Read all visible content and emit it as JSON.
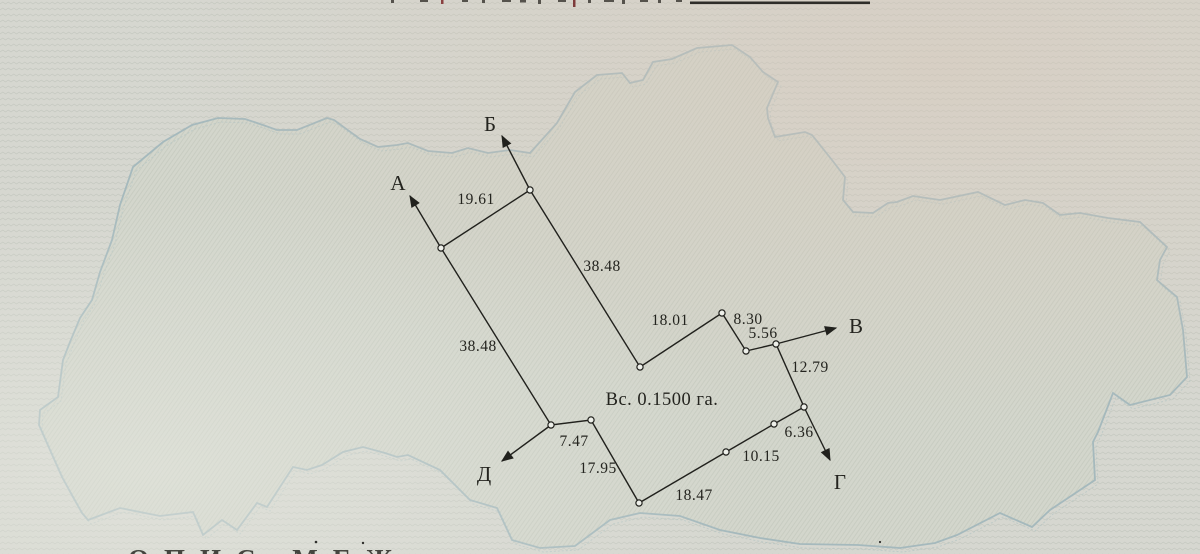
{
  "map": {
    "area_label": "Вс. 0.1500 га.",
    "rays": [
      {
        "label": "А"
      },
      {
        "label": "Б"
      },
      {
        "label": "В"
      },
      {
        "label": "Г"
      },
      {
        "label": "Д"
      }
    ],
    "edges": [
      {
        "length": "19.61"
      },
      {
        "length": "38.48"
      },
      {
        "length": "18.01"
      },
      {
        "length": "8.30"
      },
      {
        "length": "5.56"
      },
      {
        "length": "12.79"
      },
      {
        "length": "6.36"
      },
      {
        "length": "10.15"
      },
      {
        "length": "18.47"
      },
      {
        "length": "17.95"
      },
      {
        "length": "7.47"
      },
      {
        "length": "38.48"
      }
    ]
  },
  "footer": {
    "cutoff_text": "ОПИС МЕЖ"
  },
  "colors": {
    "boundary": "#a2b7bc",
    "survey_line": "#21211d",
    "paper": "#d6d7d0"
  }
}
